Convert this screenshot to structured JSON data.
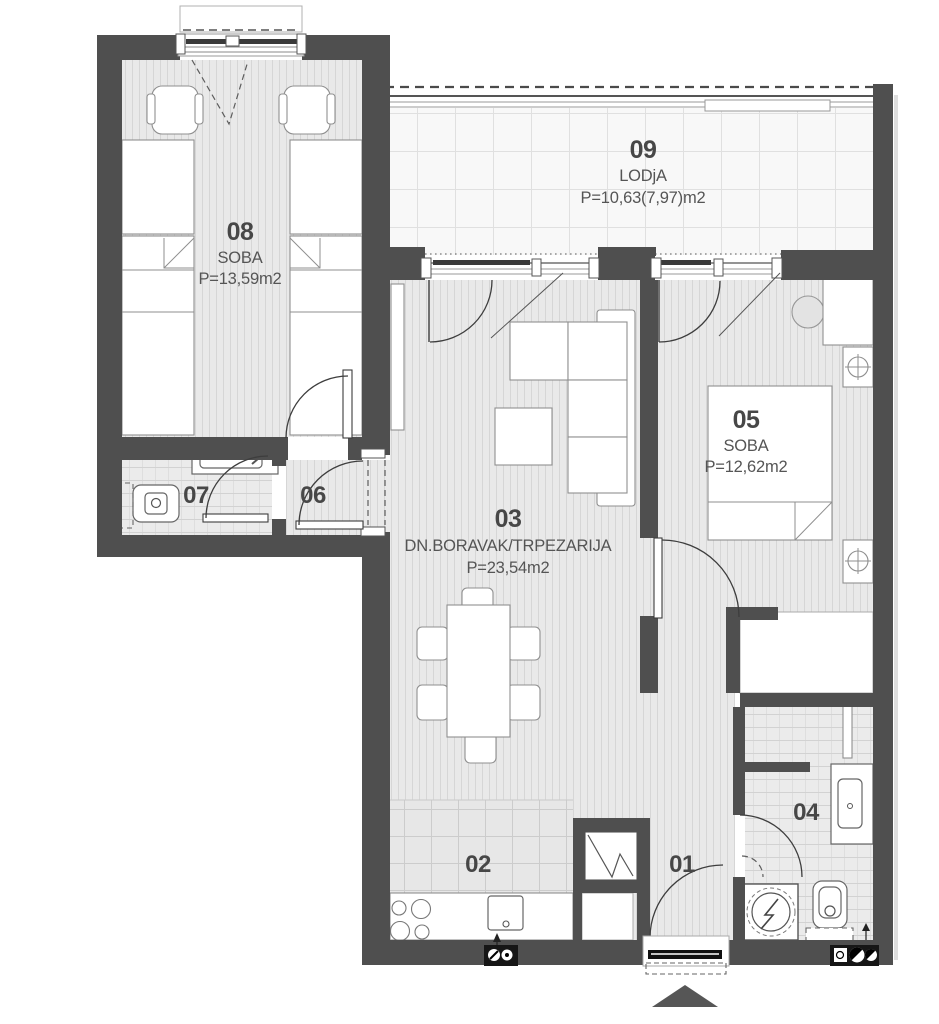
{
  "plan": {
    "rooms": {
      "r01": {
        "id": "01"
      },
      "r02": {
        "id": "02"
      },
      "r03": {
        "id": "03",
        "name": "DN.BORAVAK/TRPEZARIJA",
        "area": "P=23,54m2"
      },
      "r04": {
        "id": "04"
      },
      "r05": {
        "id": "05",
        "name": "SOBA",
        "area": "P=12,62m2"
      },
      "r06": {
        "id": "06"
      },
      "r07": {
        "id": "07"
      },
      "r08": {
        "id": "08",
        "name": "SOBA",
        "area": "P=13,59m2"
      },
      "r09": {
        "id": "09",
        "name": "LODjA",
        "area": "P=10,63(7,97)m2"
      }
    },
    "colors": {
      "wall": "#4f4f4f",
      "floor": "#e9e9e9",
      "tile": "#ebebeb",
      "lodja_floor": "#f8f8f8",
      "furniture_outline": "#8f8f8f"
    }
  }
}
